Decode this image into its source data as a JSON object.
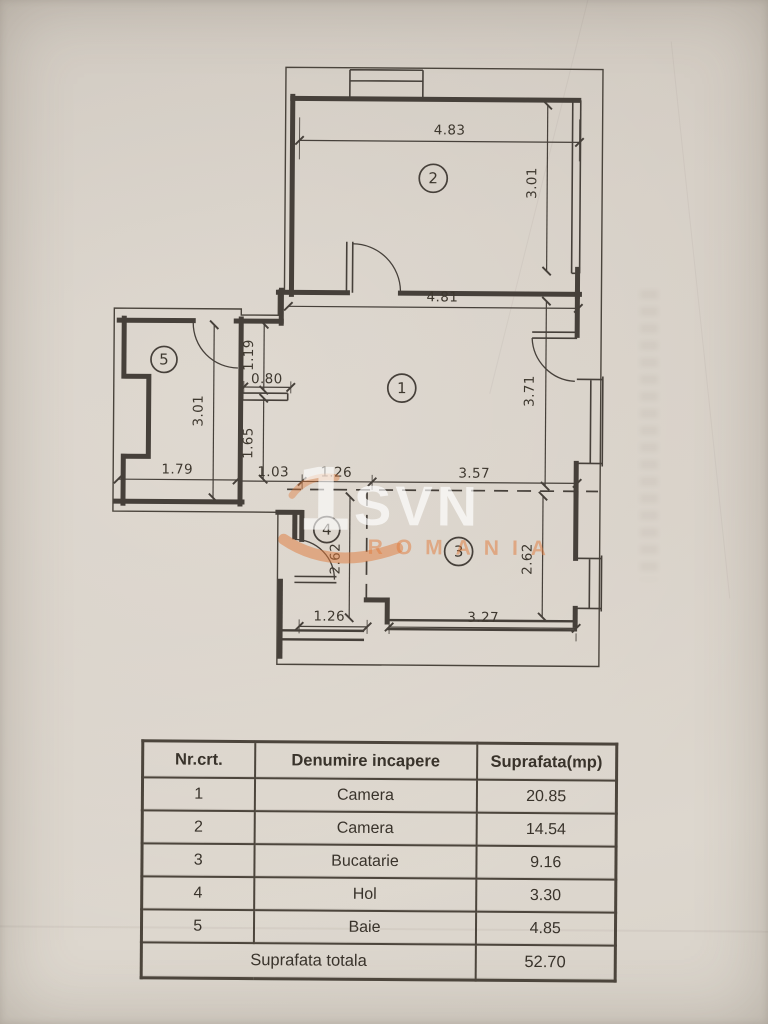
{
  "watermark": {
    "mark": "1",
    "brand": "SVN",
    "country": "ROMANIA",
    "accent_color": "#e07a3a"
  },
  "plan": {
    "room_labels": {
      "camera1": "1",
      "camera2": "2",
      "bucatarie": "3",
      "hol": "4",
      "baie": "5"
    },
    "dims": {
      "room2_width": "4.83",
      "room2_height": "3.01",
      "room1_width": "4.81",
      "room1_height": "3.71",
      "room1_bottom": "3.57",
      "niche_height": "1.19",
      "shelf_width": "0.80",
      "entry_height": "1.65",
      "entry_width": "1.03",
      "hall_top_width": "1.26",
      "hall_height": "2.62",
      "hall_bottom_width": "1.26",
      "kitchen_height": "2.62",
      "kitchen_width": "3.27",
      "bath_width": "1.79",
      "bath_height": "3.01"
    }
  },
  "table": {
    "headers": [
      "Nr.crt.",
      "Denumire incapere",
      "Suprafata(mp)"
    ],
    "rows": [
      [
        "1",
        "Camera",
        "20.85"
      ],
      [
        "2",
        "Camera",
        "14.54"
      ],
      [
        "3",
        "Bucatarie",
        "9.16"
      ],
      [
        "4",
        "Hol",
        "3.30"
      ],
      [
        "5",
        "Baie",
        "4.85"
      ]
    ],
    "total_label": "Suprafata totala",
    "total_value": "52.70"
  }
}
